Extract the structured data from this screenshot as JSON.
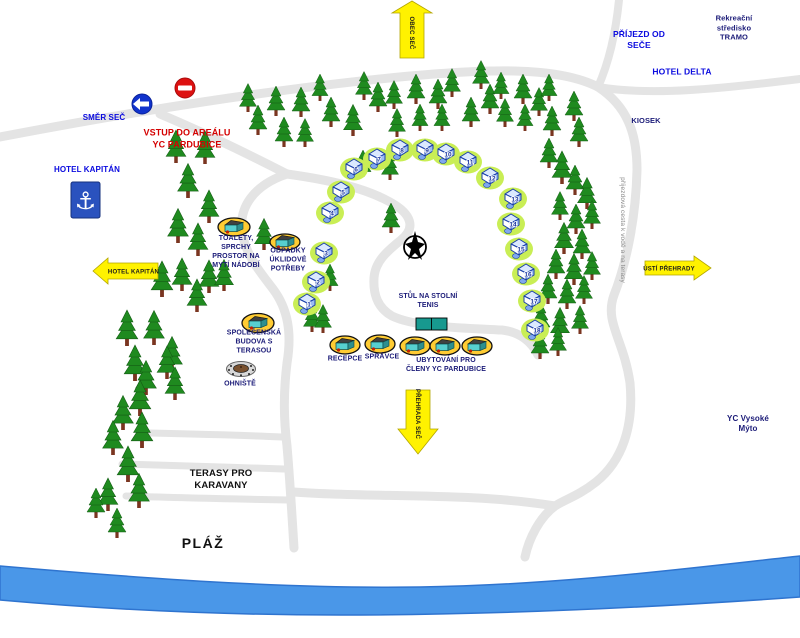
{
  "colors": {
    "label_blue": "#0a0adf",
    "label_navy": "#1b1b78",
    "label_red": "#d40000",
    "label_black": "#111111",
    "arrow_yellow": "#fff200",
    "road_gray": "#e4e4e4",
    "water_blue": "#4a97e8",
    "tree_green": "#1f8a1f",
    "cabin_blob_green": "#c9ee55",
    "building_oval_yellow": "#ffcc33",
    "sign_blue": "#1133cc",
    "sign_red": "#dd1111"
  },
  "icons": {
    "anchor_glyph": "⚓"
  },
  "arrows": {
    "obec_sec": {
      "label": "OBEC SEČ"
    },
    "prehrada_sec": {
      "label": "PŘEHRADA SEČ"
    },
    "usti_prehrady": {
      "label": "ÚSTÍ PŘEHRADY"
    },
    "hotel_kapitan": {
      "label": "HOTEL KAPITÁN"
    }
  },
  "labels": [
    {
      "name": "label-smer-sec",
      "text": "SMĚR SEČ",
      "x": 104,
      "y": 118,
      "cls": "c-blue s8"
    },
    {
      "name": "label-vstup-do-arealu",
      "text": "VSTUP DO AREÁLU\nYC PARDUBICE",
      "x": 187,
      "y": 139,
      "cls": "c-red s9"
    },
    {
      "name": "label-prijezd-od-sece",
      "text": "PŘÍJEZD OD\nSEČE",
      "x": 639,
      "y": 40,
      "cls": "c-blue s85"
    },
    {
      "name": "label-tramo",
      "text": "Rekreační středisko\nTRAMO",
      "x": 734,
      "y": 28,
      "cls": "c-navy s75"
    },
    {
      "name": "label-hotel-delta",
      "text": "HOTEL DELTA",
      "x": 682,
      "y": 72,
      "cls": "c-blue s85"
    },
    {
      "name": "label-kiosek",
      "text": "KIOSEK",
      "x": 646,
      "y": 121,
      "cls": "c-navy s75"
    },
    {
      "name": "label-hotel-kapitan",
      "text": "HOTEL KAPITÁN",
      "x": 87,
      "y": 170,
      "cls": "c-blue s8"
    },
    {
      "name": "label-toalety",
      "text": "TOALETY,\nSPRCHY\nPROSTOR NA\nMYTÍ NÁDOBÍ",
      "x": 236,
      "y": 253,
      "cls": "c-navy s7"
    },
    {
      "name": "label-odpadky",
      "text": "ODPADKY\nÚKLIDOVÉ\nPOTŘEBY",
      "x": 288,
      "y": 261,
      "cls": "c-navy s7"
    },
    {
      "name": "label-stul-tenis",
      "text": "STŮL NA STOLNÍ\nTENIS",
      "x": 428,
      "y": 302,
      "cls": "c-navy s7"
    },
    {
      "name": "label-recepce",
      "text": "RECEPCE",
      "x": 345,
      "y": 360,
      "cls": "c-navy s7"
    },
    {
      "name": "label-spravce",
      "text": "SPRÁVCE",
      "x": 382,
      "y": 358,
      "cls": "c-navy s7"
    },
    {
      "name": "label-ubytovani",
      "text": "UBYTOVÁNÍ PRO\nČLENY YC PARDUBICE",
      "x": 446,
      "y": 366,
      "cls": "c-navy s7"
    },
    {
      "name": "label-spolecenska",
      "text": "SPOLEČENSKÁ\nBUDOVA S\nTERASOU",
      "x": 254,
      "y": 343,
      "cls": "c-navy s7"
    },
    {
      "name": "label-ohniste",
      "text": "OHNIŠTĚ",
      "x": 240,
      "y": 385,
      "cls": "c-navy s7"
    },
    {
      "name": "label-yc-vysoke-myto",
      "text": "YC Vysoké Mýto",
      "x": 748,
      "y": 424,
      "cls": "c-navy s8"
    },
    {
      "name": "label-terasy",
      "text": "TERASY PRO\nKARAVANY",
      "x": 221,
      "y": 480,
      "cls": "c-black s95"
    },
    {
      "name": "label-plaz",
      "text": "PLÁŽ",
      "x": 203,
      "y": 544,
      "cls": "c-black s14"
    },
    {
      "name": "label-prijezdova-cesta",
      "text": "příjezdová cesta k vodě a na terasy",
      "x": 622,
      "y": 230,
      "cls": "c-gray s6 rot90"
    }
  ],
  "facilities": [
    {
      "name": "toalety-building",
      "cx": 234,
      "cy": 227,
      "rx": 16,
      "ry": 9
    },
    {
      "name": "odpadky-building",
      "cx": 285,
      "cy": 242,
      "rx": 15,
      "ry": 8
    },
    {
      "name": "spolecenska-building",
      "cx": 258,
      "cy": 323,
      "rx": 16,
      "ry": 9.5
    },
    {
      "name": "recepce-building",
      "cx": 345,
      "cy": 345,
      "rx": 15,
      "ry": 9
    },
    {
      "name": "spravce-building",
      "cx": 380,
      "cy": 344,
      "rx": 15,
      "ry": 9
    },
    {
      "name": "ubytovani-building-1",
      "cx": 415,
      "cy": 346,
      "rx": 15,
      "ry": 9
    },
    {
      "name": "ubytovani-building-2",
      "cx": 445,
      "cy": 346,
      "rx": 15,
      "ry": 9
    },
    {
      "name": "ubytovani-building-3",
      "cx": 477,
      "cy": 346,
      "rx": 15,
      "ry": 9
    }
  ],
  "cabins": {
    "count": 18,
    "items": [
      {
        "n": "1",
        "x": 307,
        "y": 302
      },
      {
        "n": "2",
        "x": 316,
        "y": 280
      },
      {
        "n": "3",
        "x": 324,
        "y": 251
      },
      {
        "n": "4",
        "x": 330,
        "y": 211
      },
      {
        "n": "5",
        "x": 341,
        "y": 190
      },
      {
        "n": "6",
        "x": 354,
        "y": 167
      },
      {
        "n": "7",
        "x": 377,
        "y": 157
      },
      {
        "n": "8",
        "x": 400,
        "y": 148
      },
      {
        "n": "9",
        "x": 425,
        "y": 148
      },
      {
        "n": "10",
        "x": 446,
        "y": 152
      },
      {
        "n": "11",
        "x": 468,
        "y": 160
      },
      {
        "n": "12",
        "x": 490,
        "y": 176
      },
      {
        "n": "13",
        "x": 513,
        "y": 197
      },
      {
        "n": "14",
        "x": 511,
        "y": 222
      },
      {
        "n": "15",
        "x": 519,
        "y": 247
      },
      {
        "n": "16",
        "x": 526,
        "y": 272
      },
      {
        "n": "17",
        "x": 532,
        "y": 299
      },
      {
        "n": "18",
        "x": 535,
        "y": 328
      }
    ]
  }
}
